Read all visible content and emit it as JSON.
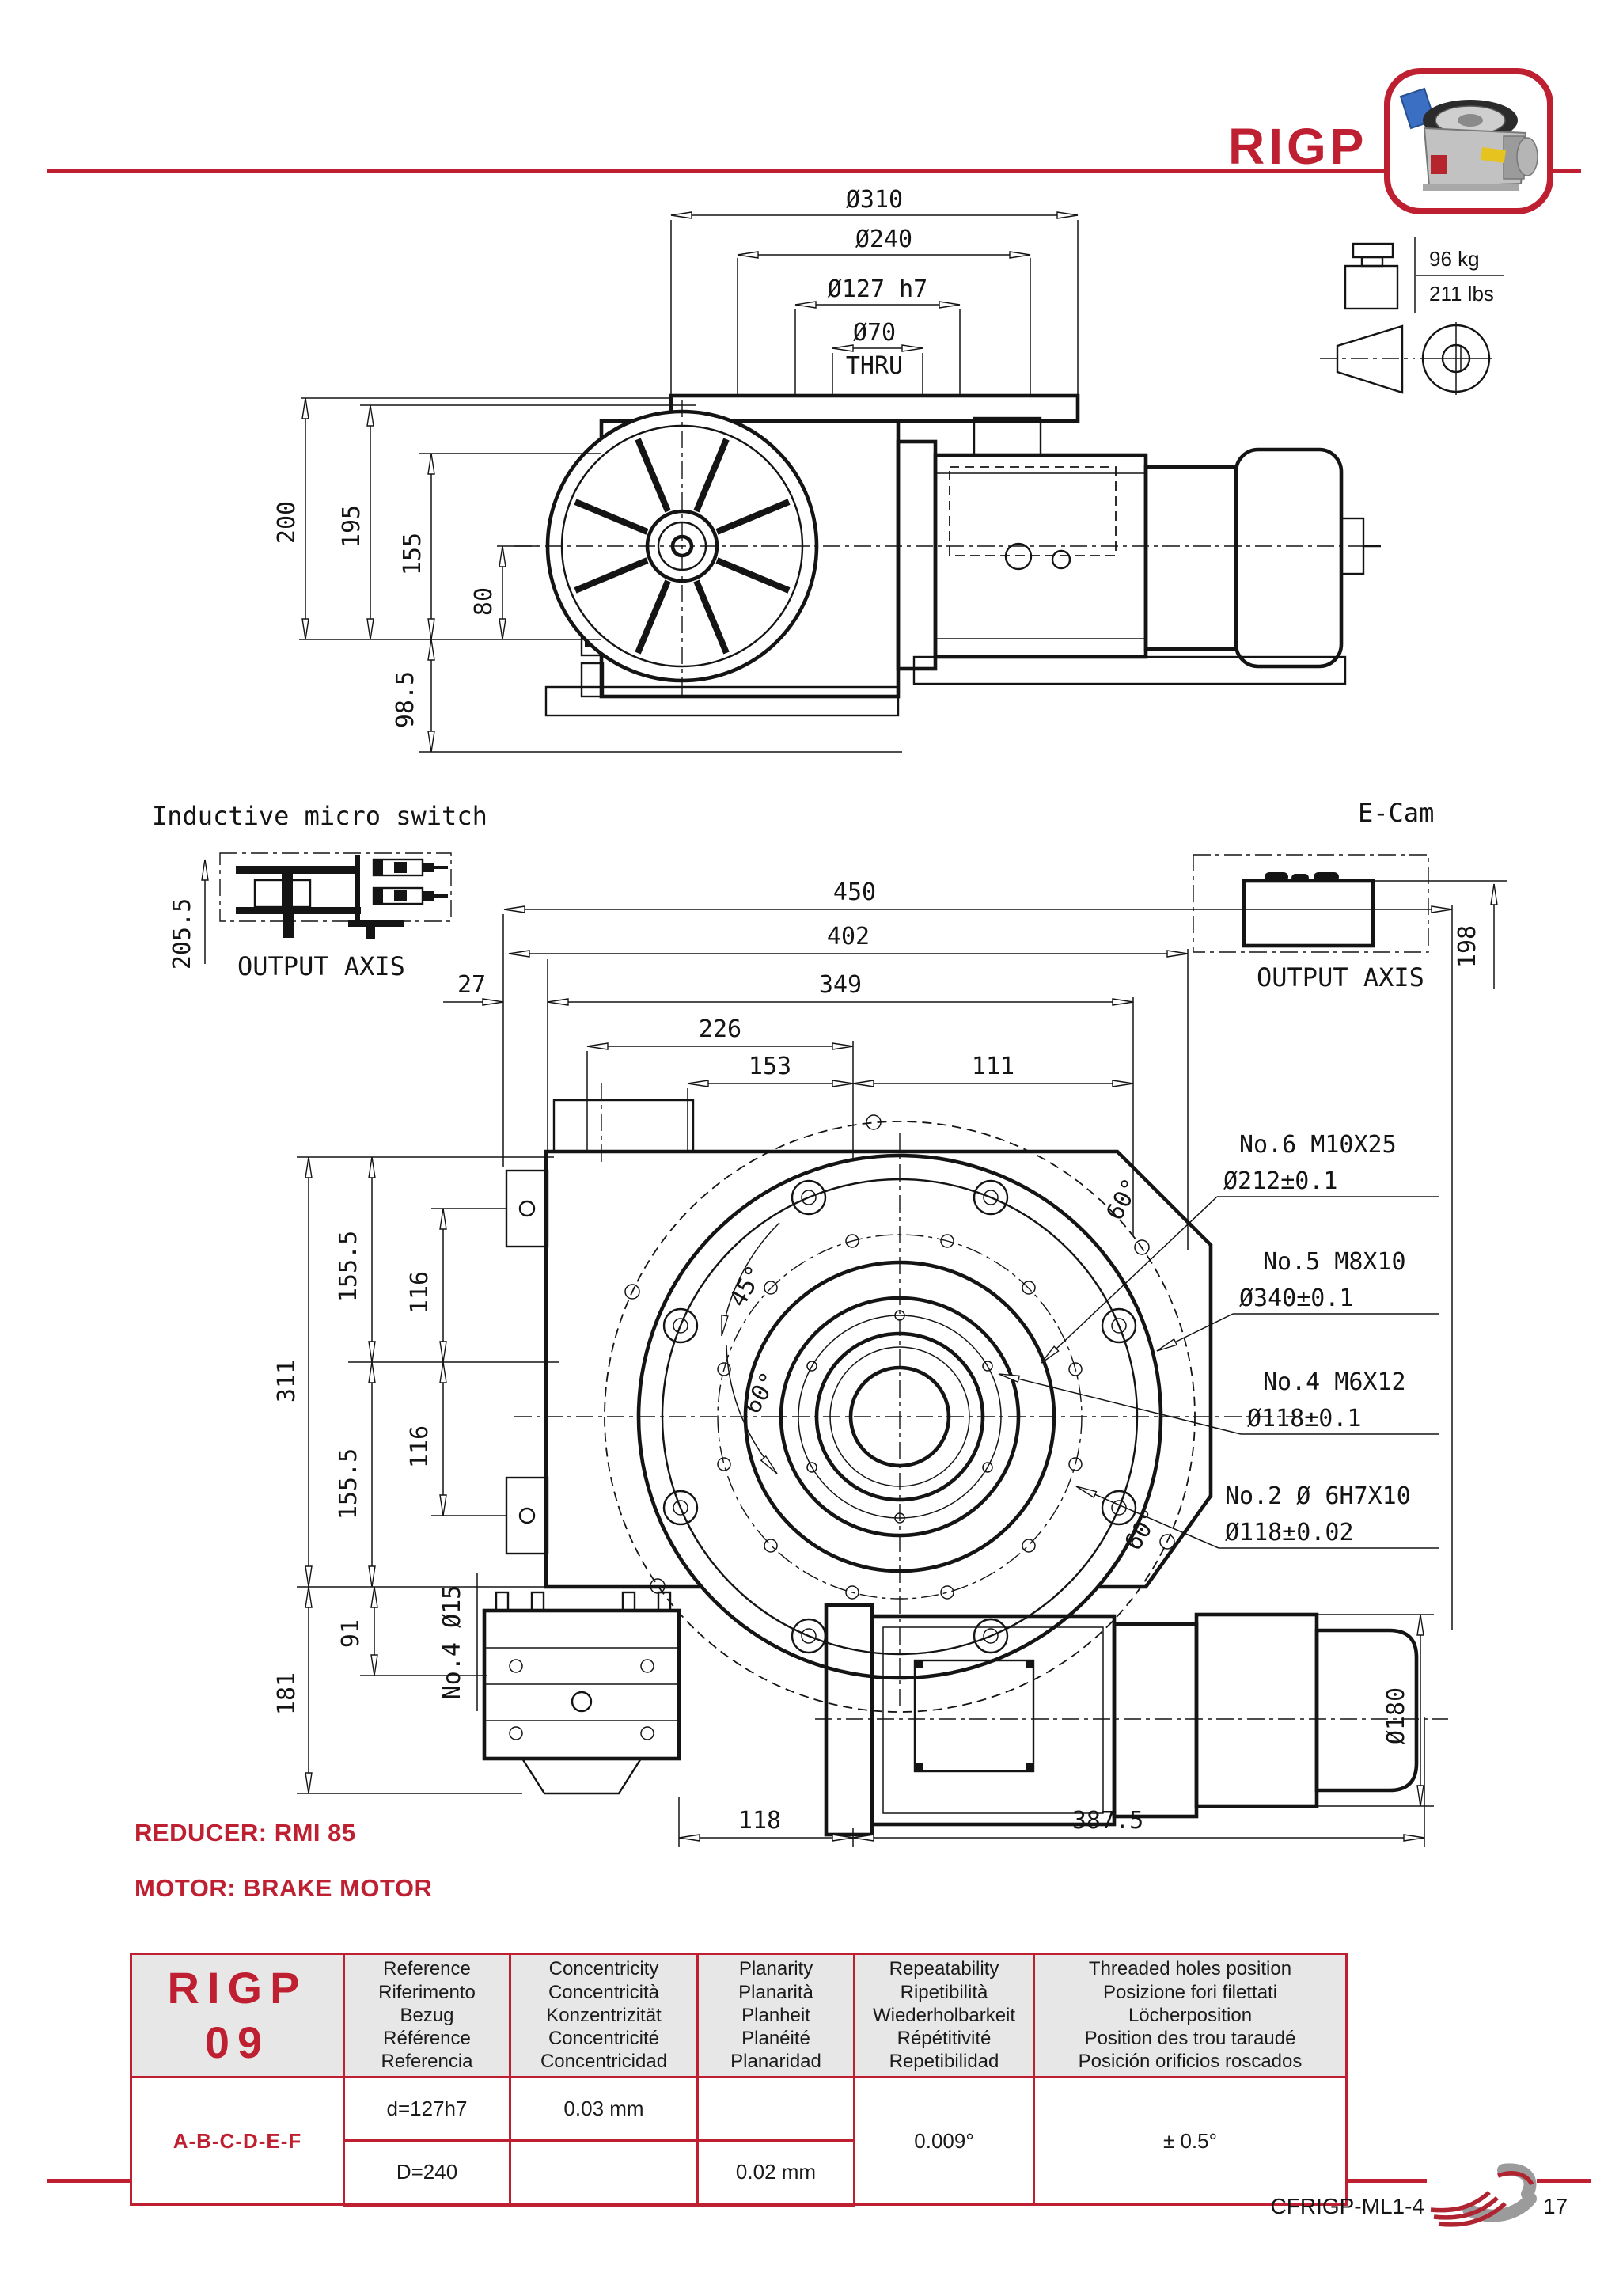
{
  "header": {
    "title": "RIGP"
  },
  "colors": {
    "accent": "#bf2031",
    "line": "#141414",
    "table_header_bg": "#e7e7e7"
  },
  "weight": {
    "kg": "96 kg",
    "lbs": "211 lbs"
  },
  "top_view": {
    "dims": {
      "d310": "Ø310",
      "d240": "Ø240",
      "d127": "Ø127 h7",
      "d70": "Ø70",
      "thru": "THRU",
      "v200": "200",
      "v195": "195",
      "v155": "155",
      "v80": "80",
      "v98_5": "98.5"
    }
  },
  "micro_switch": {
    "title": "Inductive micro switch",
    "output_axis": "OUTPUT AXIS",
    "v205_5": "205.5"
  },
  "ecam": {
    "title": "E-Cam",
    "output_axis": "OUTPUT AXIS",
    "v198": "198"
  },
  "front_view": {
    "dims": {
      "w450": "450",
      "w402": "402",
      "w349": "349",
      "w27": "27",
      "w226": "226",
      "w153": "153",
      "w111": "111",
      "v311": "311",
      "v155_5": "155.5",
      "v116": "116",
      "v181": "181",
      "v91": "91",
      "no4_d15": "No.4 Ø15",
      "w118": "118",
      "w387_5": "387.5",
      "d180": "Ø180",
      "a45": "45°",
      "a60": "60°"
    },
    "callouts": [
      {
        "line1": "No.6 M10X25",
        "line2": "Ø212±0.1"
      },
      {
        "line1": "No.5 M8X10",
        "line2": "Ø340±0.1"
      },
      {
        "line1": "No.4 M6X12",
        "line2": "Ø118±0.1"
      },
      {
        "line1": "No.2 Ø 6H7X10",
        "line2": "Ø118±0.02"
      }
    ]
  },
  "notes": {
    "reducer": "REDUCER: RMI 85",
    "motor": "MOTOR: BRAKE MOTOR"
  },
  "table": {
    "model_line1": "RIGP",
    "model_line2": "09",
    "variant": "A-B-C-D-E-F",
    "headers": [
      {
        "lines": [
          "Reference",
          "Riferimento",
          "Bezug",
          "Référence",
          "Referencia"
        ]
      },
      {
        "lines": [
          "Concentricity",
          "Concentricità",
          "Konzentrizität",
          "Concentricité",
          "Concentricidad"
        ]
      },
      {
        "lines": [
          "Planarity",
          "Planarità",
          "Planheit",
          "Planéité",
          "Planaridad"
        ]
      },
      {
        "lines": [
          "Repeatability",
          "Ripetibilità",
          "Wiederholbarkeit",
          "Répétitivité",
          "Repetibilidad"
        ]
      },
      {
        "lines": [
          "Threaded holes position",
          "Posizione fori filettati",
          "Löcherposition",
          "Position des trou taraudé",
          "Posición orificios roscados"
        ]
      }
    ],
    "rows": {
      "r1": {
        "reference": "d=127h7",
        "concentricity": "0.03 mm",
        "planarity": "",
        "repeatability": "0.009°",
        "threaded": "± 0.5°"
      },
      "r2": {
        "reference": "D=240",
        "concentricity": "",
        "planarity": "0.02 mm"
      }
    }
  },
  "footer": {
    "code": "CFRIGP-ML1-4",
    "page": "17"
  }
}
